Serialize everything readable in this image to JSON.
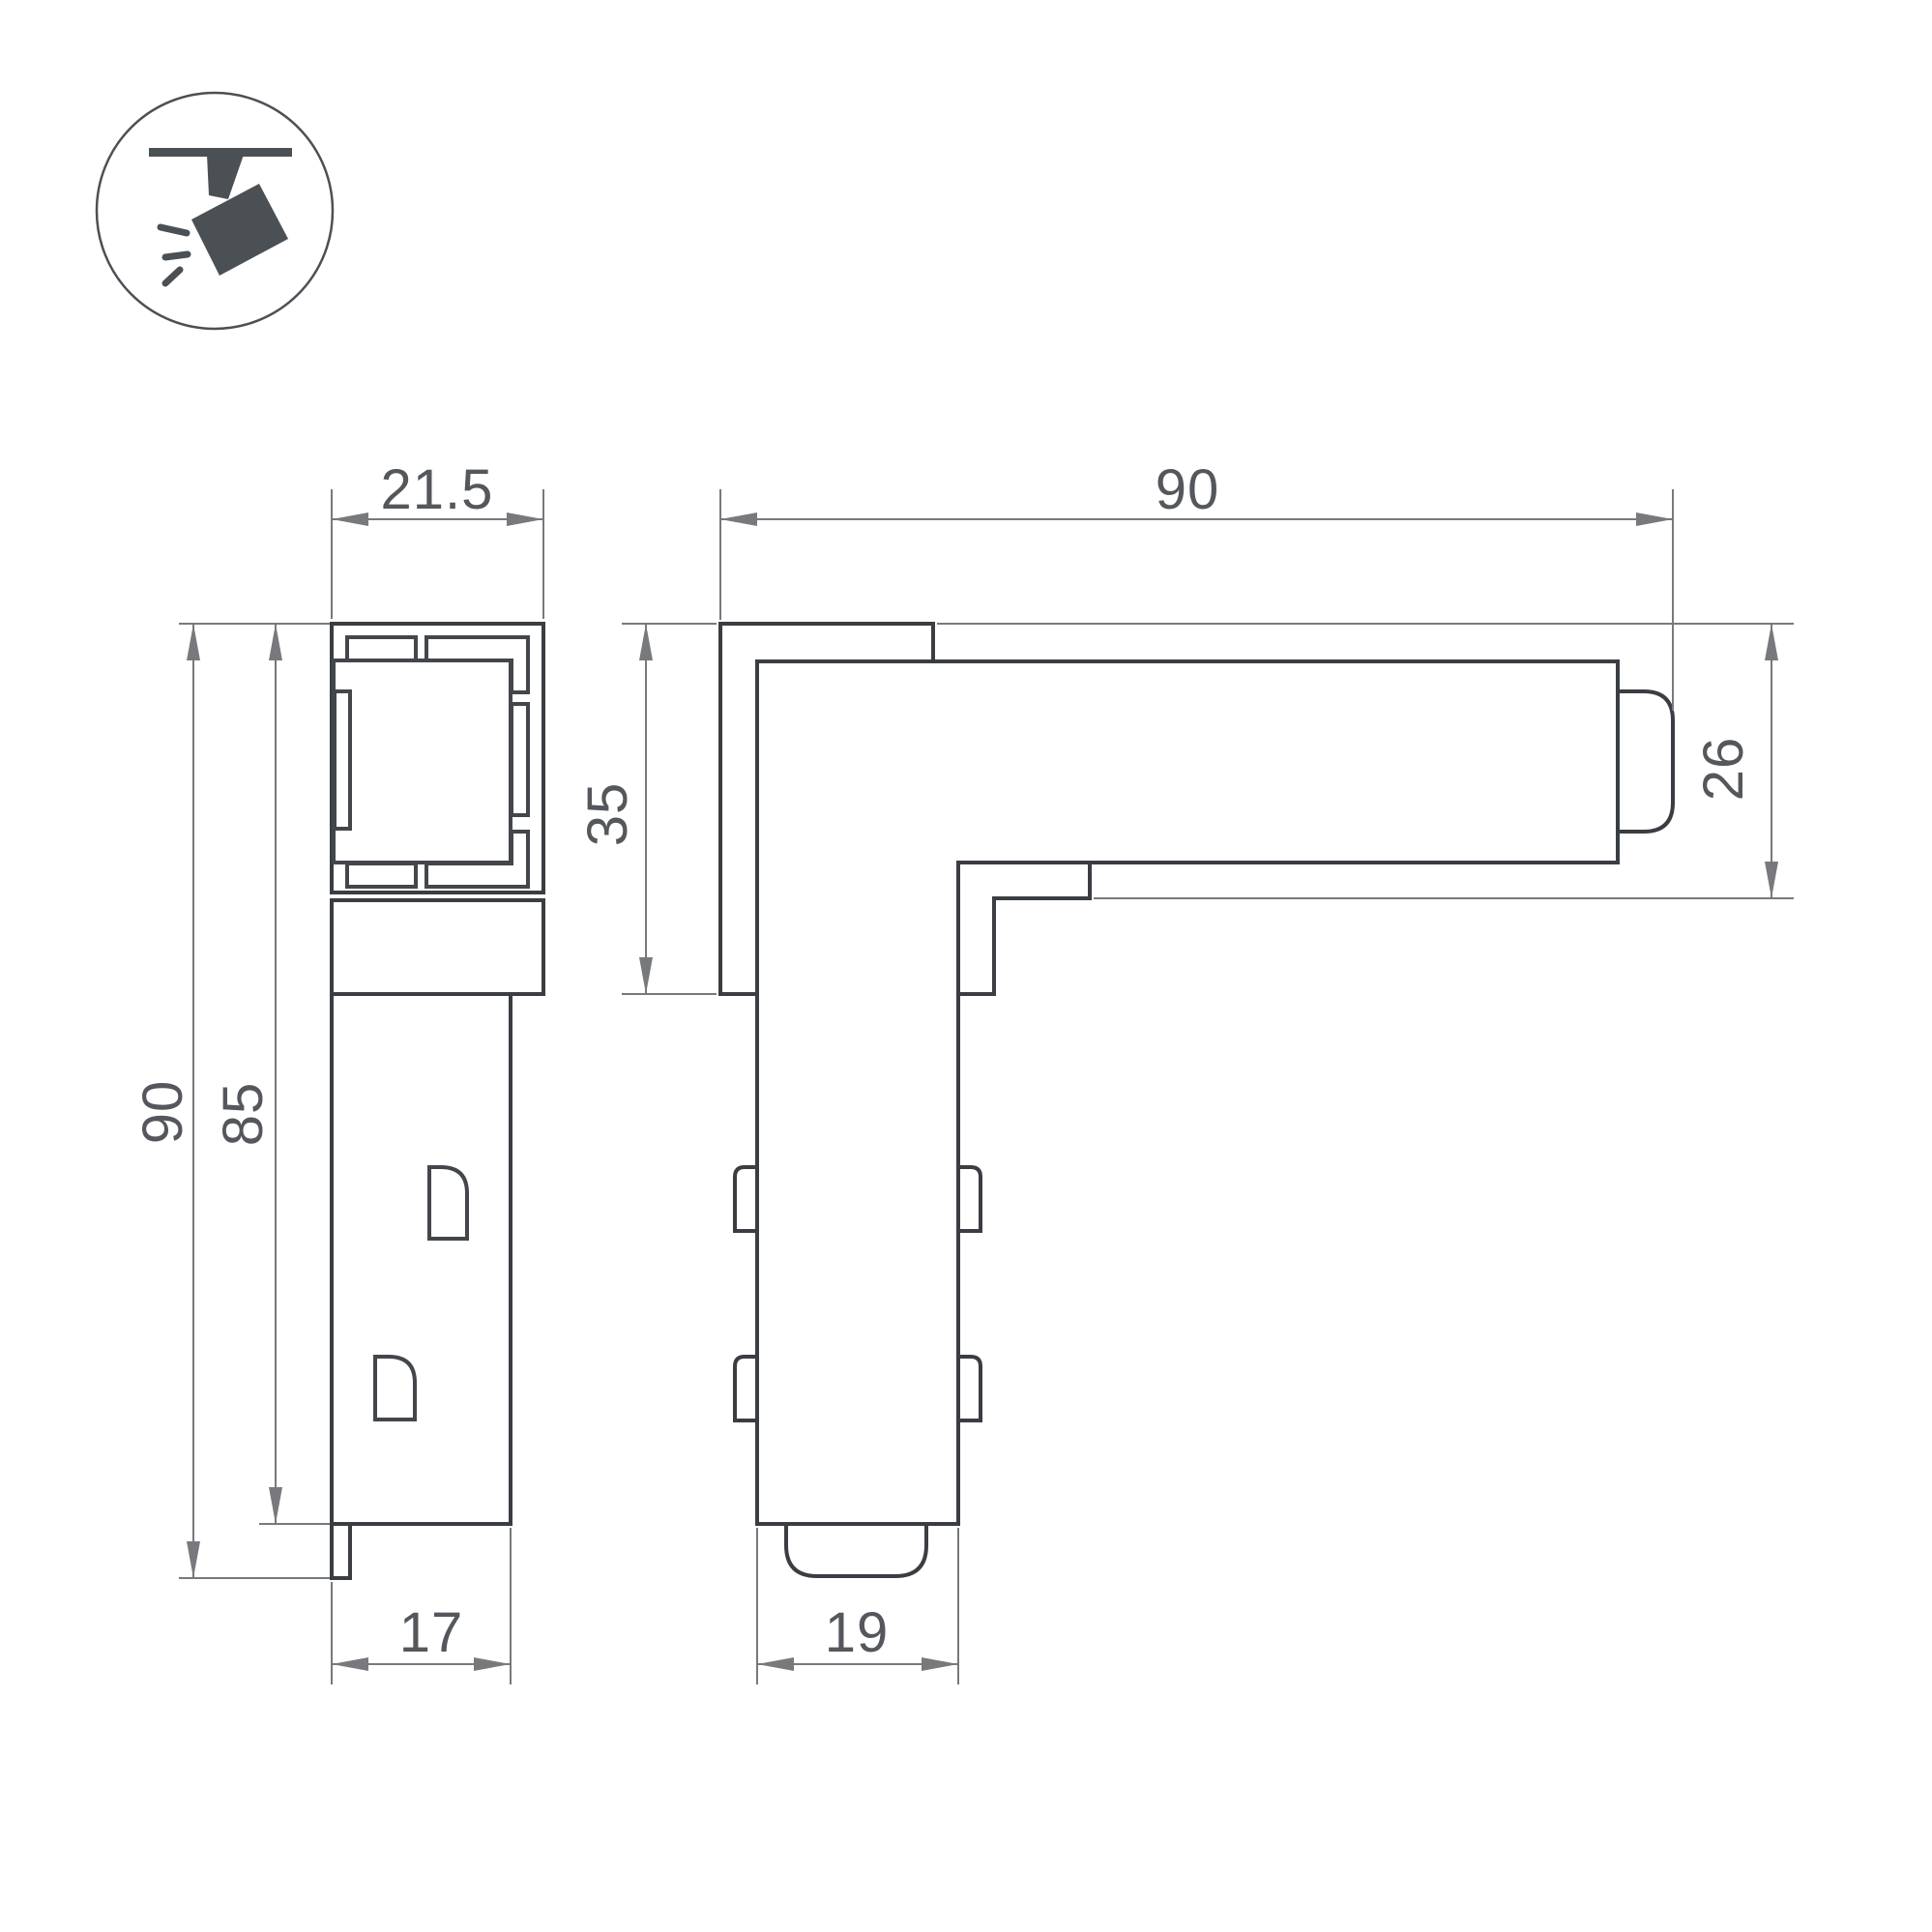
{
  "icon": {
    "name": "track-spotlight-icon"
  },
  "colors": {
    "outline": "#3a3e42",
    "inner": "#43474b",
    "dimension": "#77797d",
    "text": "#54575b",
    "icon": "#4b5055",
    "background": "#ffffff"
  },
  "views": {
    "front": {
      "dimensions": {
        "track_width": "21.5",
        "overall_height": "90",
        "body_height": "85",
        "body_width": "17"
      }
    },
    "side": {
      "dimensions": {
        "overall_length": "90",
        "corner_height": "35",
        "track_height": "26",
        "arm_width": "19"
      }
    }
  }
}
